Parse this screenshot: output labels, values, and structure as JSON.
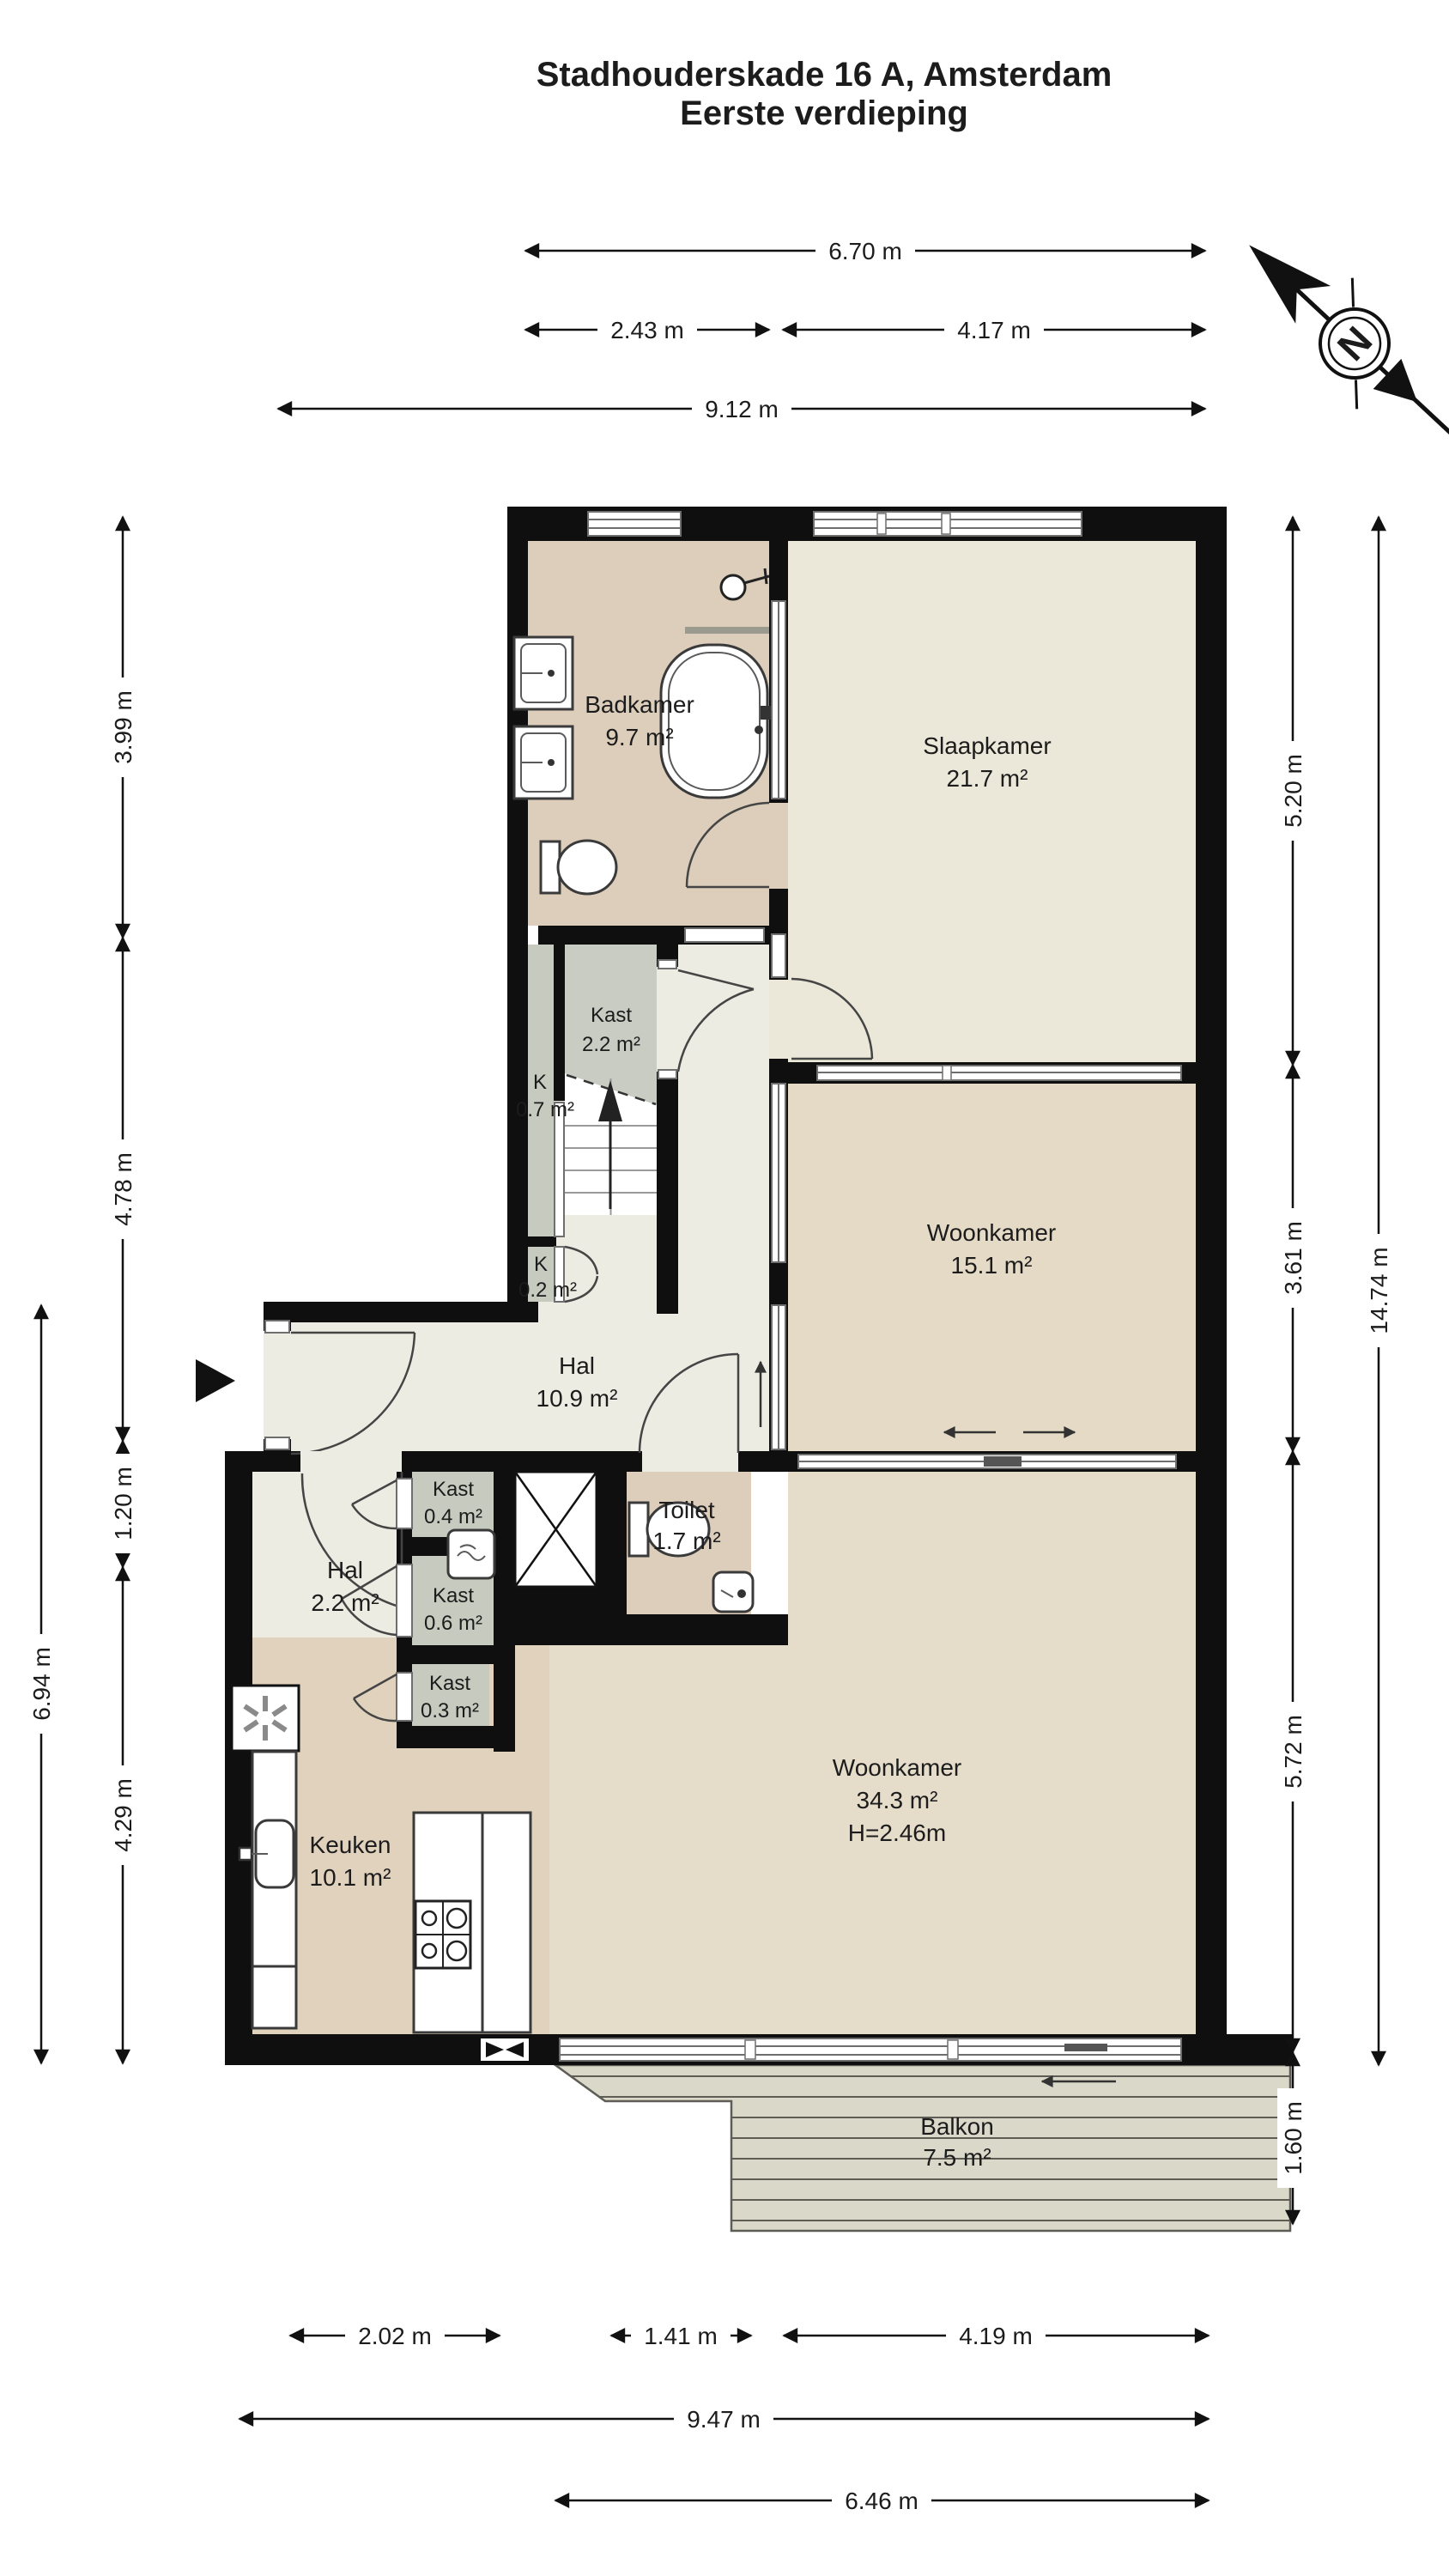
{
  "title": {
    "line1": "Stadhouderskade 16 A, Amsterdam",
    "line2": "Eerste verdieping"
  },
  "compass": {
    "north_label": "N"
  },
  "rooms": {
    "badkamer": {
      "name": "Badkamer",
      "area": "9.7 m²"
    },
    "slaapkamer": {
      "name": "Slaapkamer",
      "area": "21.7 m²"
    },
    "kast_2_2": {
      "name": "Kast",
      "area": "2.2 m²"
    },
    "k_0_7": {
      "name": "K",
      "area": "0.7 m²"
    },
    "k_0_2": {
      "name": "K",
      "area": "0.2 m²"
    },
    "woonkamer_15_1": {
      "name": "Woonkamer",
      "area": "15.1 m²"
    },
    "hal_10_9": {
      "name": "Hal",
      "area": "10.9 m²"
    },
    "kast_0_4": {
      "name": "Kast",
      "area": "0.4 m²"
    },
    "hal_2_2": {
      "name": "Hal",
      "area": "2.2 m²"
    },
    "kast_0_6": {
      "name": "Kast",
      "area": "0.6 m²"
    },
    "kast_0_3": {
      "name": "Kast",
      "area": "0.3 m²"
    },
    "toilet": {
      "name": "Toilet",
      "area": "1.7 m²"
    },
    "keuken": {
      "name": "Keuken",
      "area": "10.1 m²"
    },
    "woonkamer_34_3": {
      "name": "Woonkamer",
      "area": "34.3 m²",
      "height": "H=2.46m"
    },
    "balkon": {
      "name": "Balkon",
      "area": "7.5 m²"
    }
  },
  "dimensions": {
    "top": [
      "6.70 m",
      "2.43 m",
      "4.17 m",
      "9.12 m"
    ],
    "left": [
      "3.99 m",
      "4.78 m",
      "1.20 m",
      "4.29 m",
      "6.94 m"
    ],
    "right": [
      "5.20 m",
      "3.61 m",
      "5.72 m",
      "1.60 m",
      "14.74 m"
    ],
    "bottom": [
      "2.02 m",
      "1.41 m",
      "4.19 m",
      "9.47 m",
      "6.46 m"
    ]
  },
  "colors": {
    "wall": "#0f0f0f",
    "floor_badkamer": "#dccebb",
    "floor_slaapkamer": "#ebe7d9",
    "floor_woonkamer": "#e5dac6",
    "floor_woonkamer_groot": "#e6dcca",
    "floor_keuken": "#e0d2bc",
    "floor_hal": "#edece3",
    "floor_kast": "#c7cabf",
    "floor_balkon": "#d9d8c9"
  }
}
